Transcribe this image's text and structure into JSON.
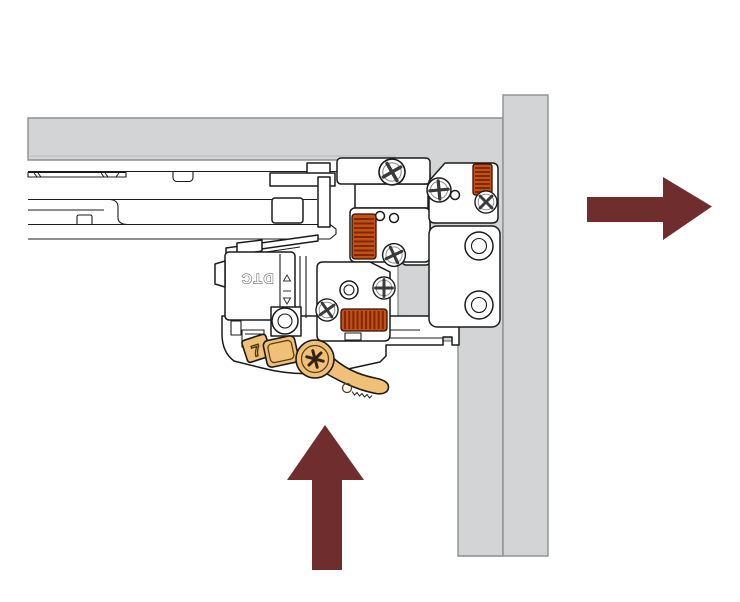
{
  "diagram": {
    "description": "Drawer slide locking device mounted at a cabinet corner, with orange adjustment wheels, screws and a release lever; arrows indicate push-up and slide-right motion",
    "logo_text": "DTC",
    "lever": {
      "mark": "7"
    },
    "colors": {
      "background": "#ffffff",
      "panel_fill": "#d3d4d6",
      "panel_stroke": "#8d8e90",
      "line": "#1b1b1b",
      "gear_fill": "#c75010",
      "gear_ridge": "#7a2a03",
      "lever_fill": "#f0c078",
      "lever_detail": "#5a4010",
      "arrow": "#702d2d"
    },
    "arrows": [
      {
        "name": "push-up-arrow",
        "direction": "up"
      },
      {
        "name": "slide-right-arrow",
        "direction": "right"
      }
    ],
    "markers": {
      "up_triangle": "adjust-up-marker",
      "down_triangle": "adjust-down-marker"
    }
  }
}
